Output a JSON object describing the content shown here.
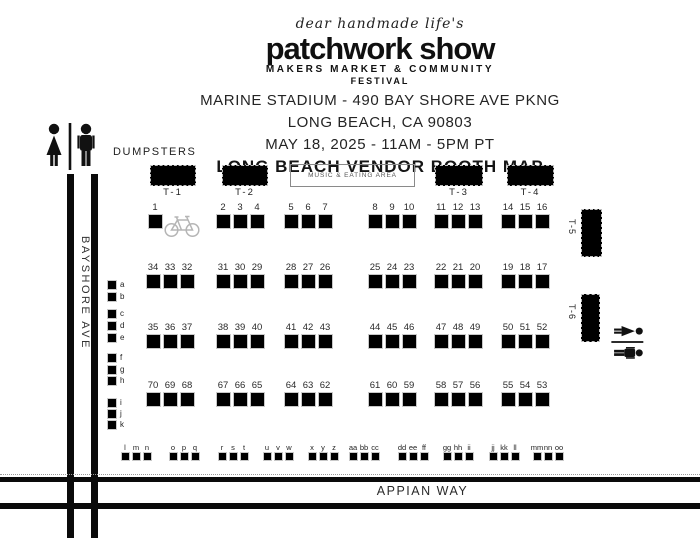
{
  "header": {
    "script_line": "dear handmade life's",
    "logo": "patchwork show",
    "tagline_1": "MAKERS MARKET & COMMUNITY",
    "tagline_2": "FESTIVAL",
    "venue_line": "MARINE STADIUM - 490 BAY SHORE AVE PKNG",
    "city_line": "LONG BEACH, CA 90803",
    "date_line": "MAY 18, 2025 - 11AM - 5PM PT",
    "map_title": "LONG BEACH VENDOR BOOTH MAP"
  },
  "map": {
    "dumpsters_label": "DUMPSTERS",
    "music_area_label": "MUSIC & EATING AREA",
    "streets": {
      "vertical": "BAYSHORE AVE",
      "horizontal": "APPIAN WAY"
    },
    "top_tents": [
      "T-1",
      "T-2",
      "T-3",
      "T-4"
    ],
    "side_tents": [
      "T-5",
      "T-6"
    ],
    "booth_rows": [
      [
        [
          "1"
        ],
        [
          "2",
          "3",
          "4"
        ],
        [
          "5",
          "6",
          "7"
        ],
        [
          "8",
          "9",
          "10"
        ],
        [
          "11",
          "12",
          "13"
        ],
        [
          "14",
          "15",
          "16"
        ]
      ],
      [
        [
          "34",
          "33",
          "32"
        ],
        [
          "31",
          "30",
          "29"
        ],
        [
          "28",
          "27",
          "26"
        ],
        [
          "25",
          "24",
          "23"
        ],
        [
          "22",
          "21",
          "20"
        ],
        [
          "19",
          "18",
          "17"
        ]
      ],
      [
        [
          "35",
          "36",
          "37"
        ],
        [
          "38",
          "39",
          "40"
        ],
        [
          "41",
          "42",
          "43"
        ],
        [
          "44",
          "45",
          "46"
        ],
        [
          "47",
          "48",
          "49"
        ],
        [
          "50",
          "51",
          "52"
        ]
      ],
      [
        [
          "70",
          "69",
          "68"
        ],
        [
          "67",
          "66",
          "65"
        ],
        [
          "64",
          "63",
          "62"
        ],
        [
          "61",
          "60",
          "59"
        ],
        [
          "58",
          "57",
          "56"
        ],
        [
          "55",
          "54",
          "53"
        ]
      ]
    ],
    "side_letter_groups": [
      [
        "a",
        "b"
      ],
      [
        "c",
        "d",
        "e"
      ],
      [
        "f",
        "g",
        "h"
      ],
      [
        "i",
        "j",
        "k"
      ]
    ],
    "bottom_letter_groups": [
      [
        "l",
        "m",
        "n"
      ],
      [
        "o",
        "p",
        "q"
      ],
      [
        "r",
        "s",
        "t"
      ],
      [
        "u",
        "v",
        "w"
      ],
      [
        "x",
        "y",
        "z"
      ],
      [
        "aa",
        "bb",
        "cc"
      ],
      [
        "dd",
        "ee",
        "ff"
      ],
      [
        "gg",
        "hh",
        "ii"
      ],
      [
        "jj",
        "kk",
        "ll"
      ],
      [
        "mm",
        "nn",
        "oo"
      ]
    ],
    "icons": {
      "left_restroom": "restroom-figures",
      "right_restroom": "restroom-figures-rotated",
      "bike": "bicycle"
    }
  },
  "colors": {
    "ink": "#111111",
    "booth_fill": "#000000",
    "bike_gray": "#b5b5b5"
  }
}
